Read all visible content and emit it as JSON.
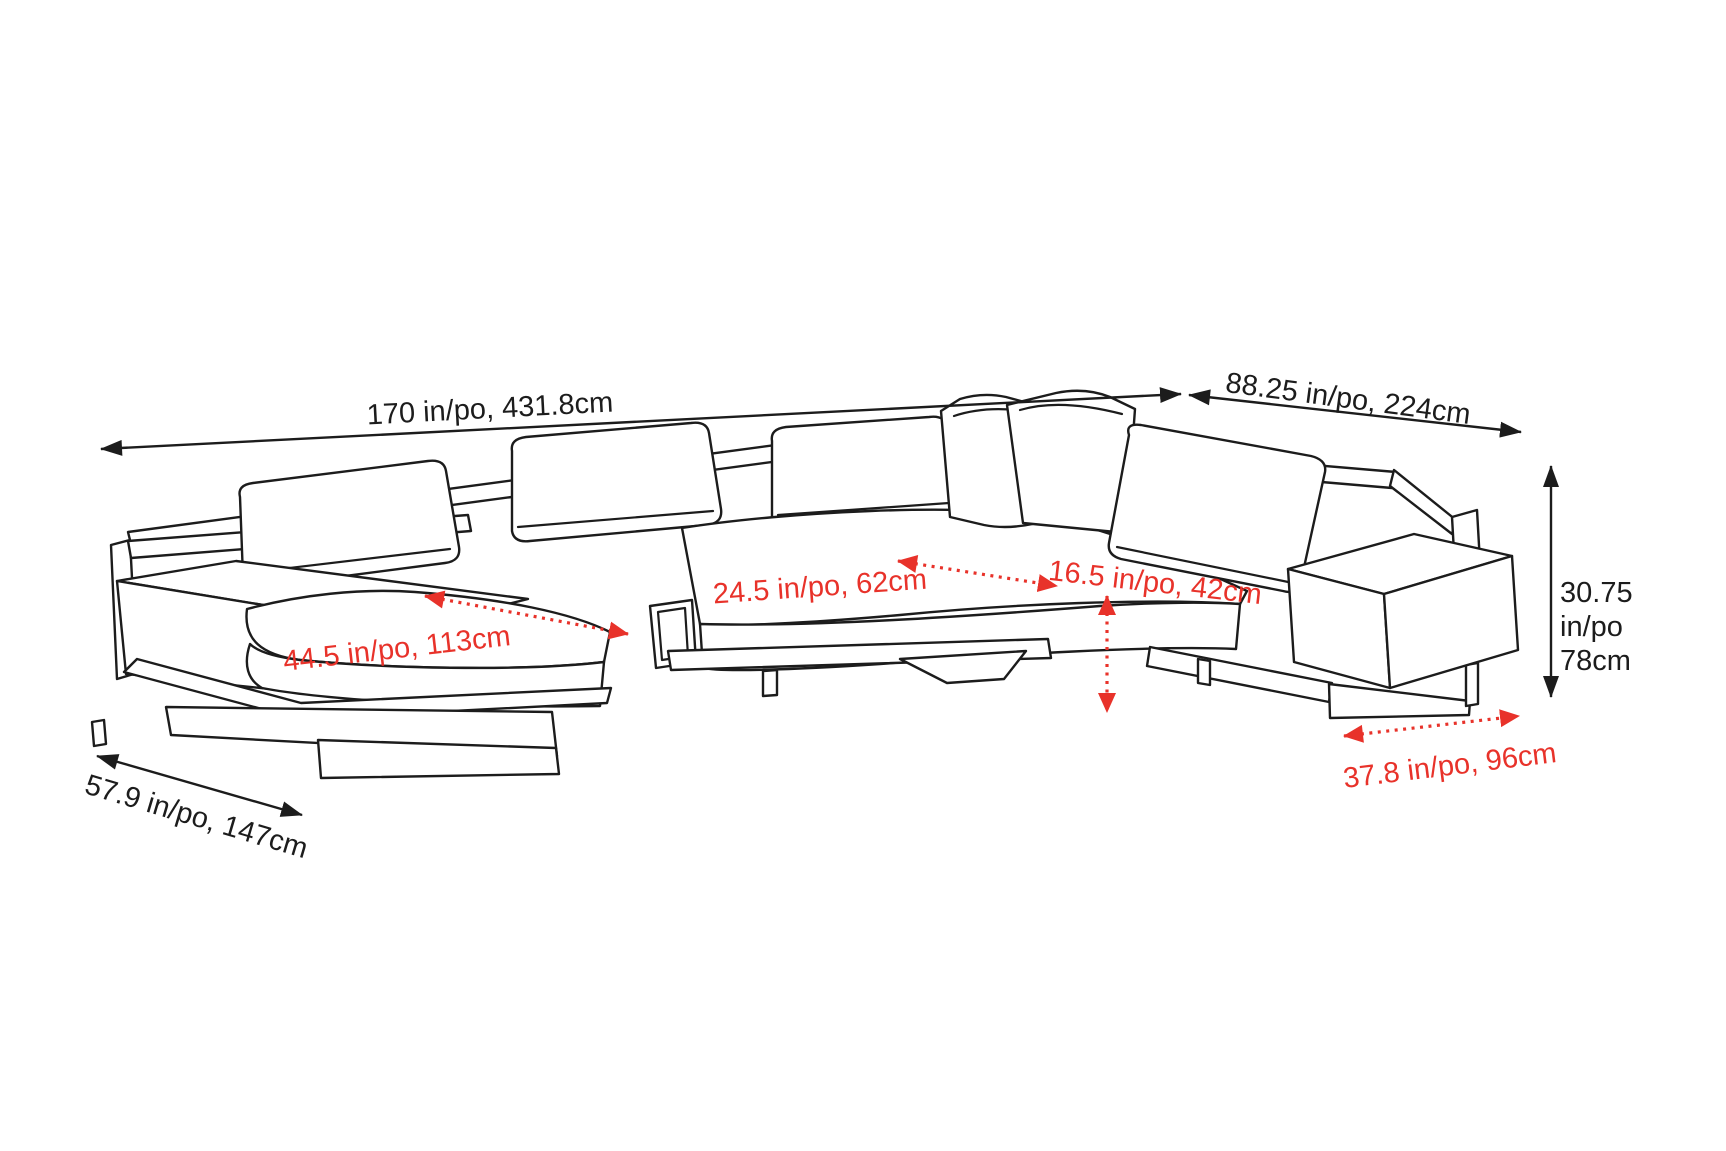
{
  "diagram": {
    "title": "sectional-sofa-dimension-diagram",
    "colors": {
      "line": "#1c1c1c",
      "dimension_accent": "#e8322a",
      "background": "#ffffff"
    },
    "dims": {
      "total_width": {
        "label": "170 in/po, 431.8cm",
        "inches": 170,
        "cm": 431.8,
        "style": "solid-black"
      },
      "right_depth": {
        "label": "88.25 in/po, 224cm",
        "inches": 88.25,
        "cm": 224,
        "style": "solid-black"
      },
      "height": {
        "line1": "30.75",
        "line2": "in/po",
        "line3": "78cm",
        "inches": 30.75,
        "cm": 78,
        "style": "solid-black"
      },
      "seat_depth": {
        "label": "24.5 in/po, 62cm",
        "inches": 24.5,
        "cm": 62,
        "style": "dotted-red"
      },
      "corner_seat": {
        "label": "16.5 in/po, 42cm",
        "inches": 16.5,
        "cm": 42,
        "style": "dotted-red"
      },
      "chaise_length": {
        "label": "44.5 in/po, 113cm",
        "inches": 44.5,
        "cm": 113,
        "style": "dotted-red"
      },
      "right_seat_width": {
        "label": "37.8 in/po, 96cm",
        "inches": 37.8,
        "cm": 96,
        "style": "dotted-red"
      },
      "chaise_depth": {
        "label": "57.9 in/po, 147cm",
        "inches": 57.9,
        "cm": 147,
        "style": "solid-black"
      }
    }
  }
}
